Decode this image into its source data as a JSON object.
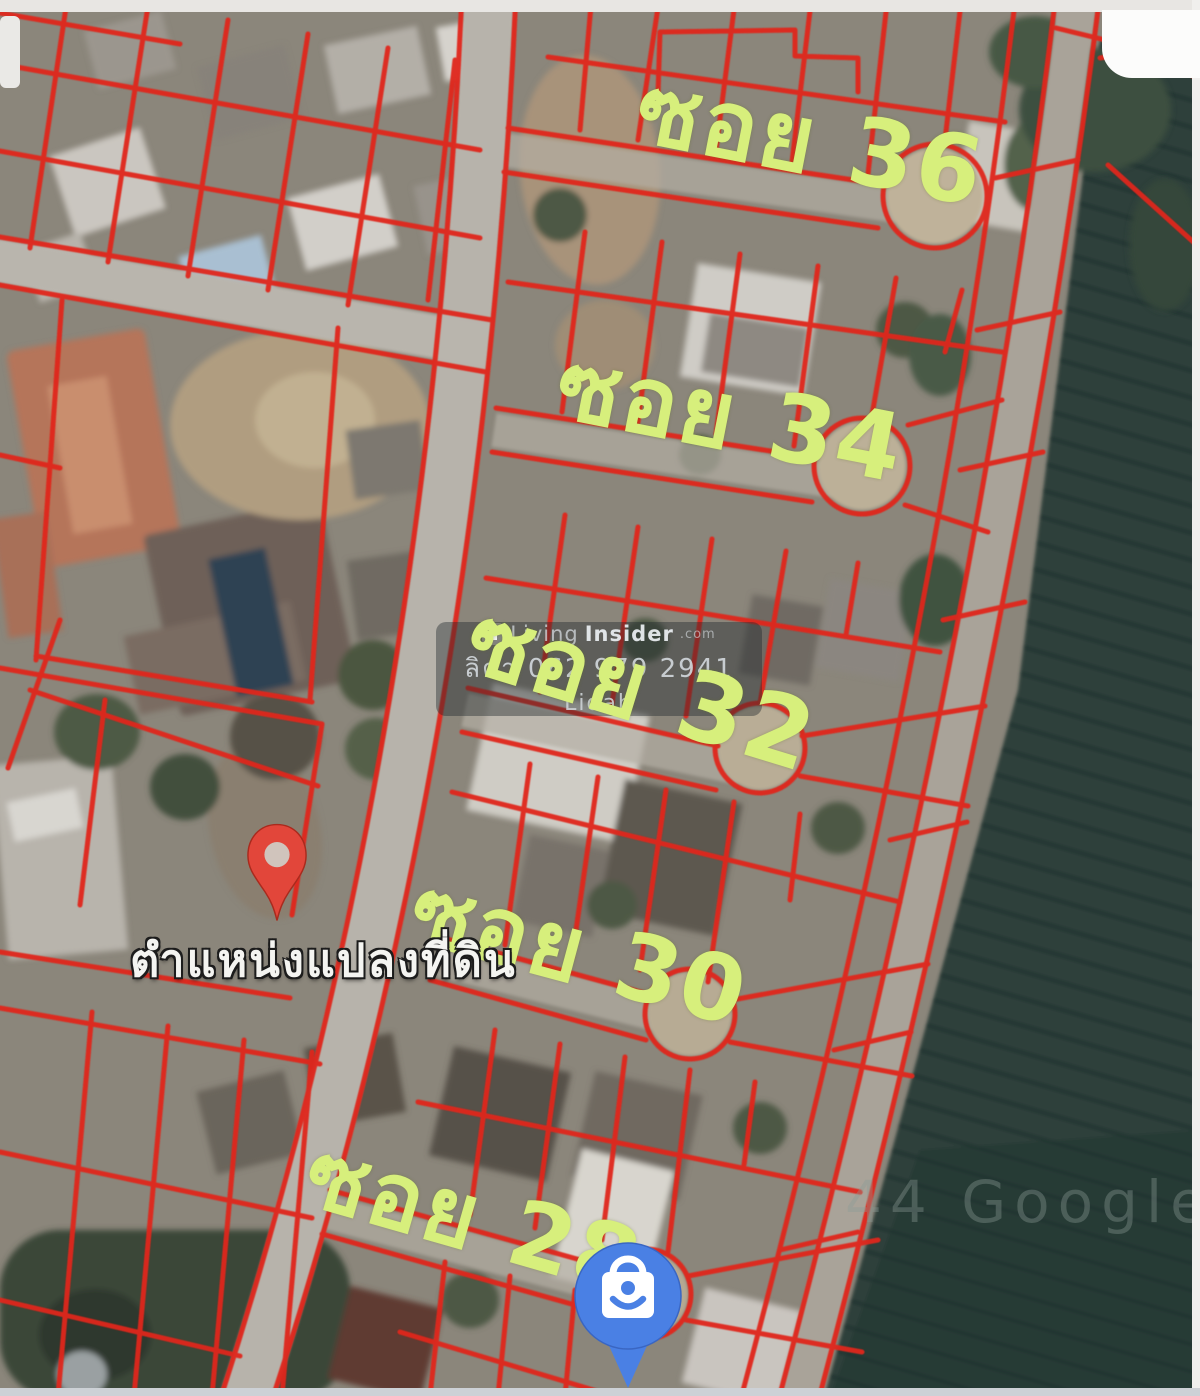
{
  "window": {
    "width": 1200,
    "height": 1396
  },
  "map": {
    "view": "satellite",
    "soi_labels": [
      {
        "text": "ซอย 36"
      },
      {
        "text": "ซอย 34"
      },
      {
        "text": "ซอย 32"
      },
      {
        "text": "ซอย 30"
      },
      {
        "text": "ซอย 28"
      }
    ],
    "location_marker": {
      "label": "ตำแหน่งแปลงที่ดิน"
    },
    "watermark": {
      "brand_light": "Living",
      "brand_bold": "Insider",
      "brand_tld": ".com",
      "phone_line": "ลิตา  062 979 2941",
      "name_line": "Lidah"
    },
    "attribution": "44 Google",
    "colors": {
      "parcel_line": "#e0261c",
      "soi_label": "#d7ef7c",
      "marker_pin": "#e2463a",
      "poi_pin": "#4a80e4"
    }
  }
}
